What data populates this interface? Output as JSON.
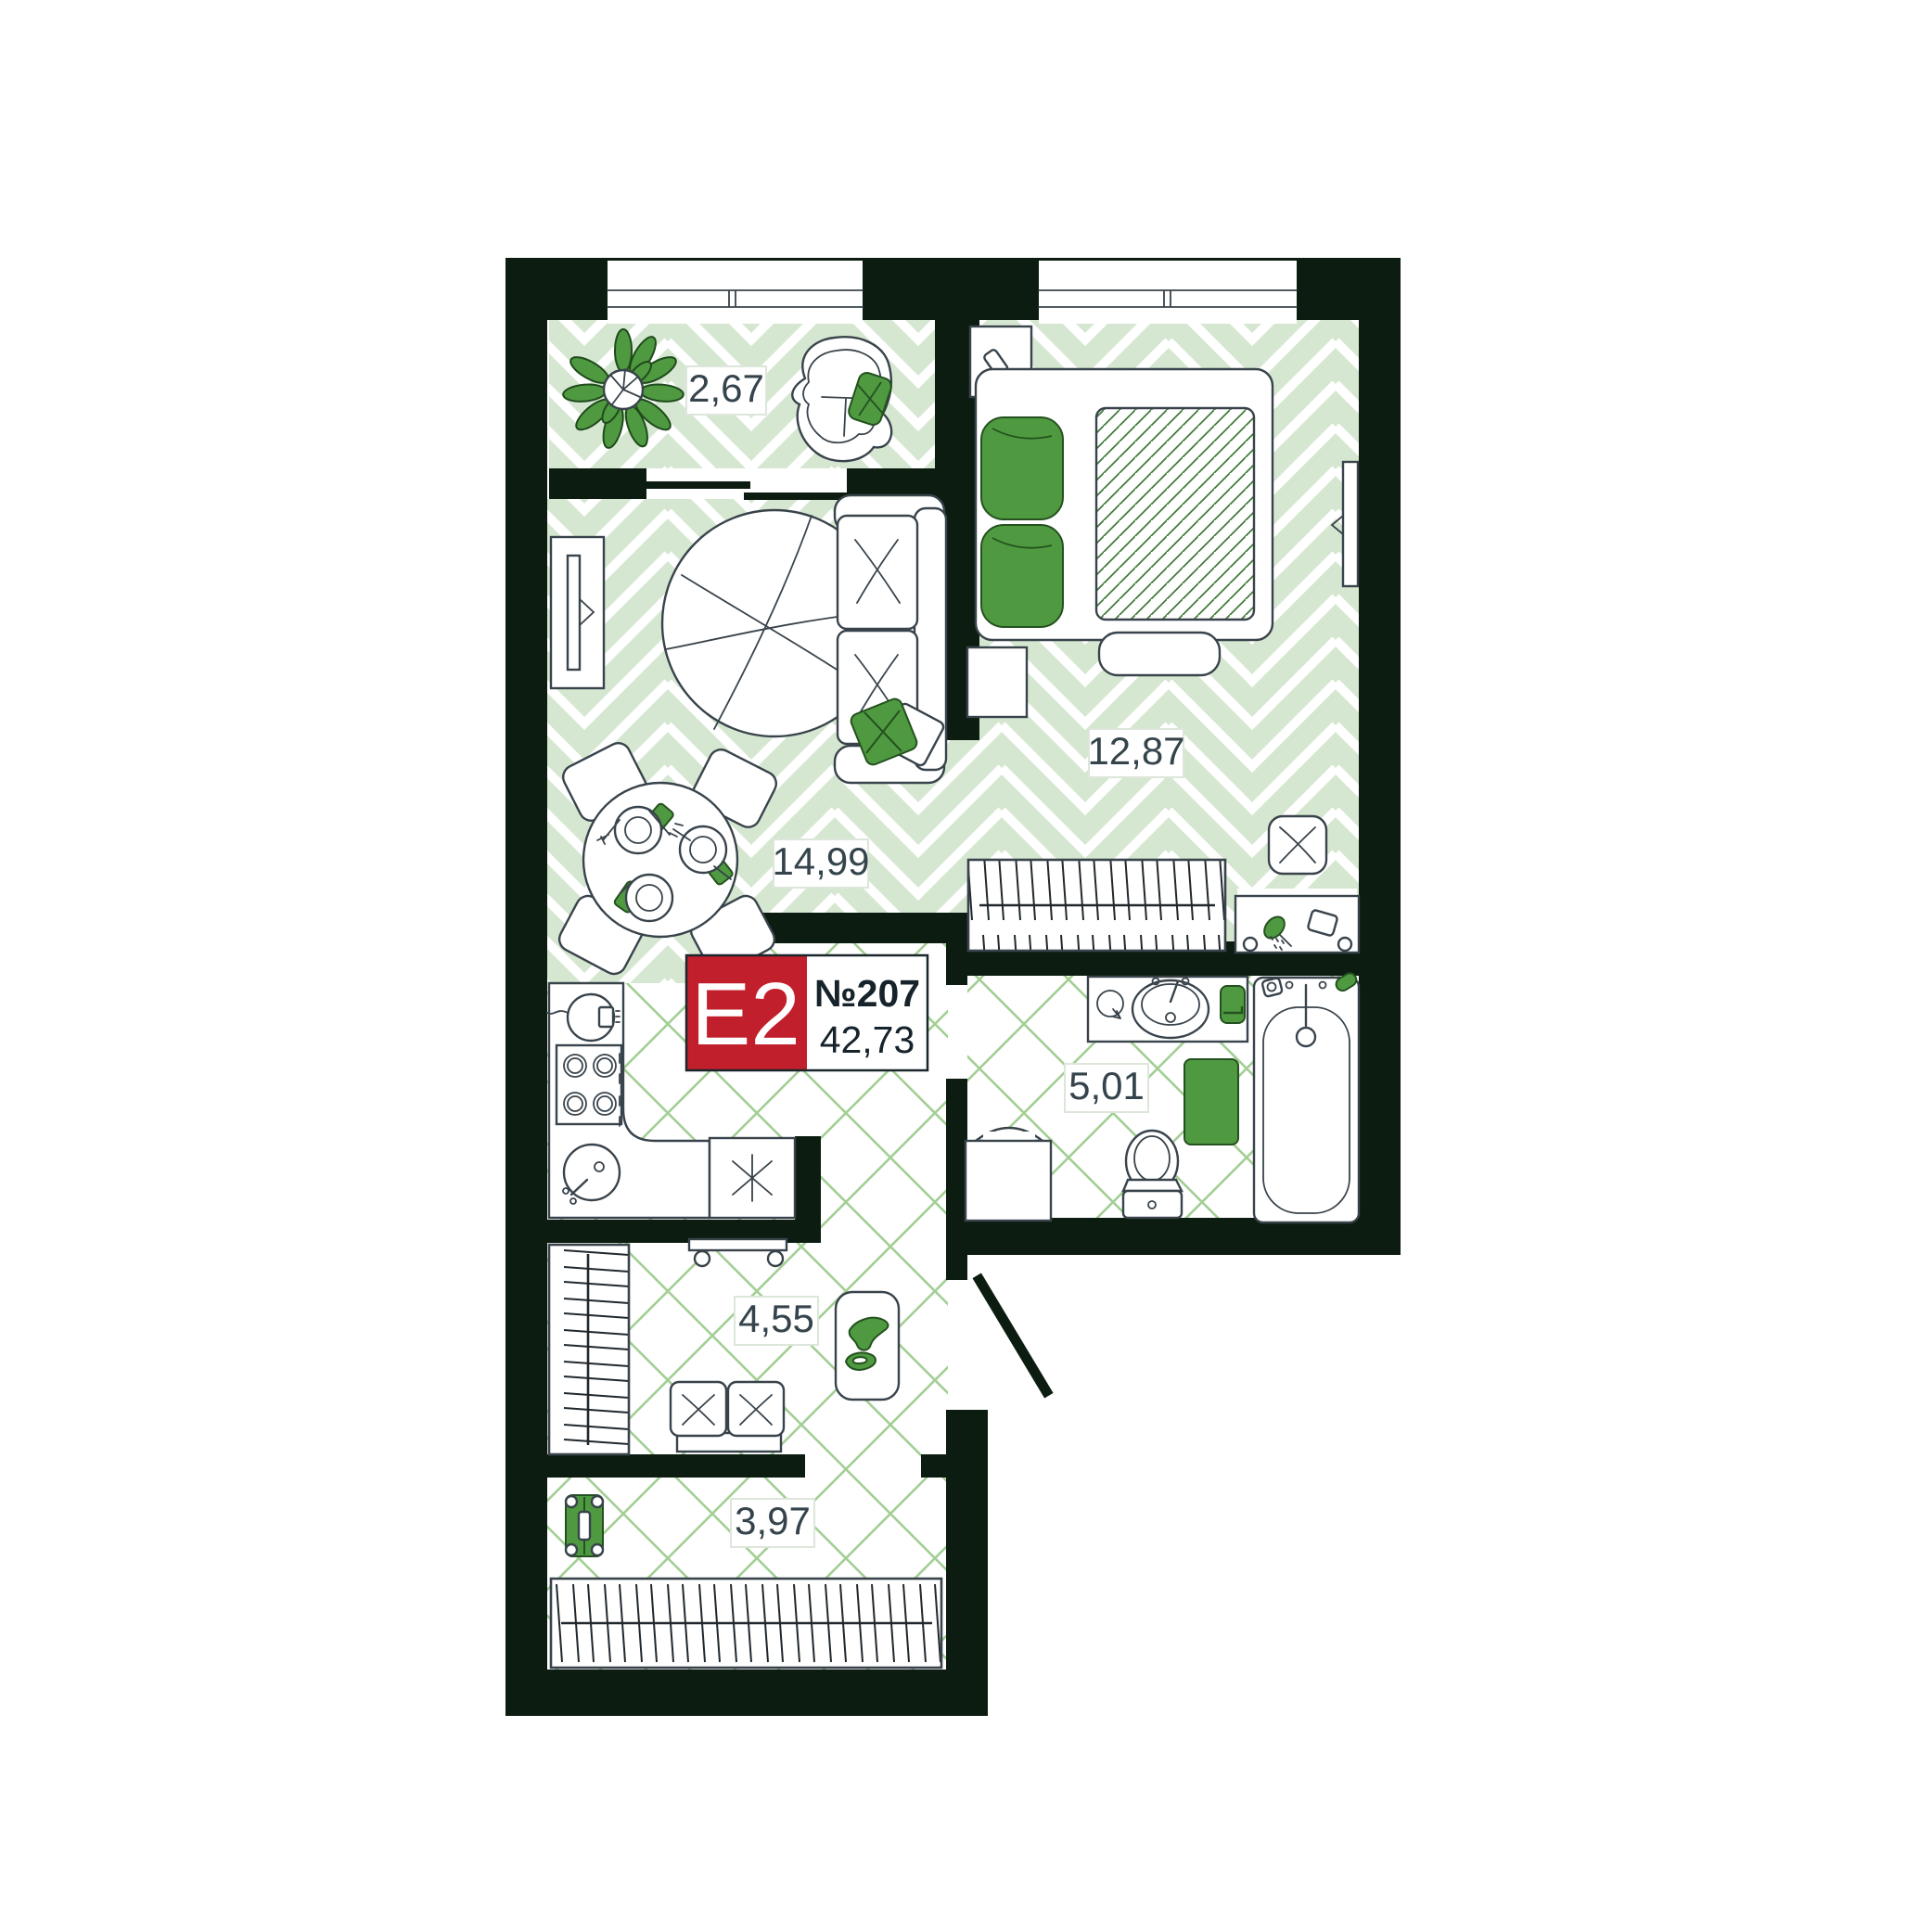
{
  "plan": {
    "badge": {
      "type_code": "E2",
      "apartment_number": "№207",
      "total_area": "42,73"
    },
    "rooms": [
      {
        "name": "balcony",
        "area": "2,67"
      },
      {
        "name": "living-kitchen",
        "area": "14,99"
      },
      {
        "name": "bedroom",
        "area": "12,87"
      },
      {
        "name": "bathroom",
        "area": "5,01"
      },
      {
        "name": "hallway",
        "area": "4,55"
      },
      {
        "name": "entry-hall",
        "area": "3,97"
      }
    ],
    "colors": {
      "wall": "#0c1c10",
      "floor_plank": "#d6e7d1",
      "tile_line": "#a3cf95",
      "accent_green": "#4f9a40",
      "badge_red": "#c21f2c",
      "label_text": "#35444c"
    }
  }
}
